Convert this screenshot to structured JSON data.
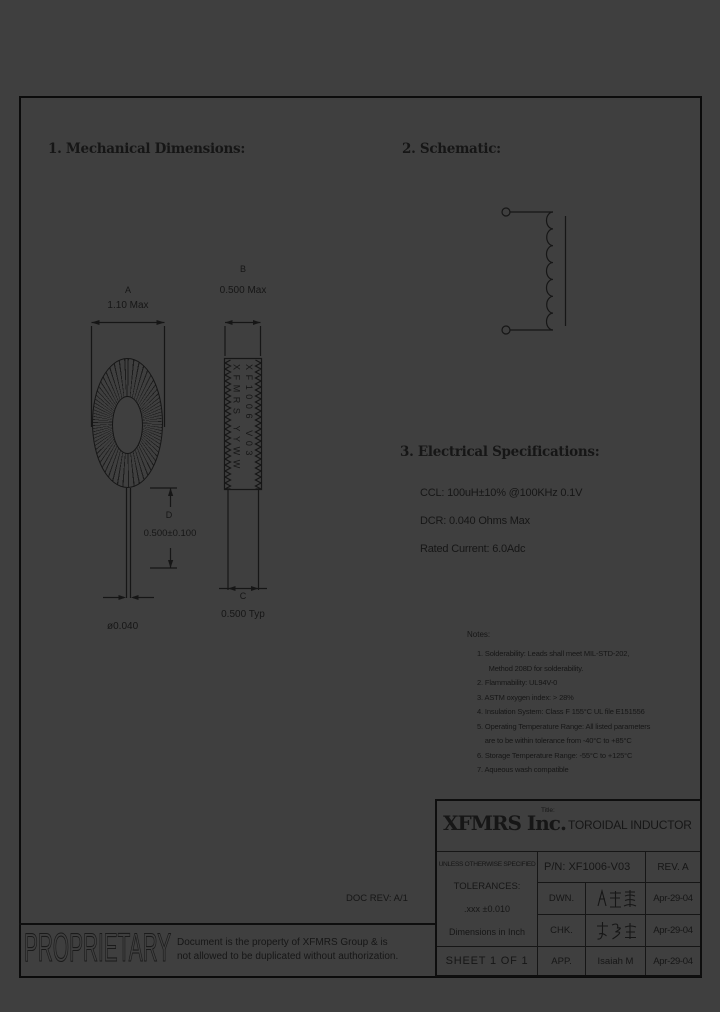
{
  "colors": {
    "background": "#3f3f3f",
    "ink": "#161616"
  },
  "doc_rev": "DOC REV: A/1",
  "sections": {
    "mechanical": {
      "heading": "1. Mechanical Dimensions:"
    },
    "schematic": {
      "heading": "2. Schematic:"
    },
    "electrical": {
      "heading": "3. Electrical Specifications:",
      "specs": [
        "CCL: 100uH±10% @100KHz 0.1V",
        "DCR: 0.040 Ohms Max",
        "Rated Current: 6.0Adc"
      ]
    }
  },
  "dimensions": {
    "a_label": "A",
    "a_value": "1.10 Max",
    "b_label": "B",
    "b_value": "0.500 Max",
    "c_label": "C",
    "c_value": "0.500 Typ",
    "d_label": "D",
    "d_value": "0.500±0.100",
    "lead_diameter": "ø0.040"
  },
  "marking": {
    "left_column": "XFMRS YYWW",
    "right_column": "XF1006 V03"
  },
  "notes": {
    "heading": "Notes:",
    "items": [
      "1. Solderability: Leads shall meet MIL-STD-202,\n      Method 208D for solderability.",
      "2. Flammability: UL94V-0",
      "3. ASTM oxygen index: > 28%",
      "4. Insulation System: Class F 155°C UL file E151556",
      "5. Operating Temperature Range: All listed parameters\n    are to be within tolerance from -40°C to +85°C",
      "6. Storage Temperature Range: -55°C to +125°C",
      "7. Aqueous wash compatible"
    ]
  },
  "title_block": {
    "company": "XFMRS Inc.",
    "title_label": "Title:",
    "title": "TOROIDAL INDUCTOR",
    "tolerances": [
      "UNLESS OTHERWISE SPECIFIED",
      "TOLERANCES:",
      ".xxx ±0.010",
      "Dimensions in Inch"
    ],
    "part_number": "P/N: XF1006-V03",
    "rev": "REV. A",
    "sheet": "SHEET 1 OF 1",
    "rows": [
      {
        "label": "DWN.",
        "signature": "廖玉霜",
        "date": "Apr-29-04"
      },
      {
        "label": "CHK.",
        "signature": "李清汇",
        "date": "Apr-29-04"
      },
      {
        "label": "APP.",
        "signature": "Isaiah M",
        "date": "Apr-29-04"
      }
    ]
  },
  "proprietary": {
    "word": "PROPRIETARY",
    "line1": "Document is the property of XFMRS Group & is",
    "line2": "not allowed to be duplicated without authorization."
  }
}
